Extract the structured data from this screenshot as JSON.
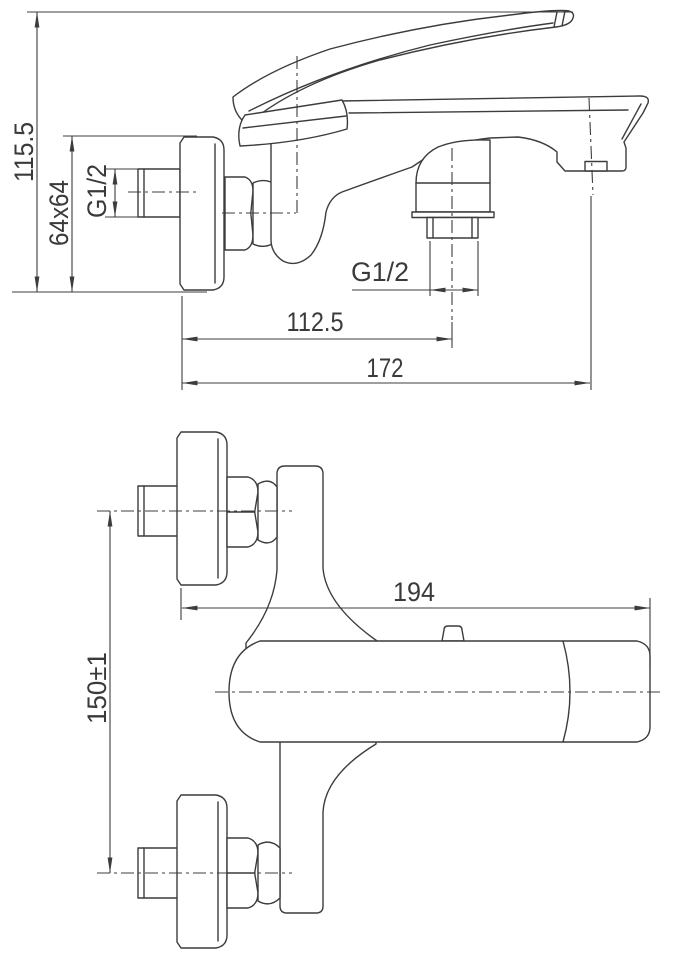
{
  "drawing": {
    "background_color": "#ffffff",
    "line_color": "#3c3c3c",
    "text_color": "#3a3a3a",
    "views": {
      "side_view": {
        "dimensions": [
          {
            "id": "overall-height",
            "label": "115.5",
            "orientation": "vertical"
          },
          {
            "id": "escutcheon-size",
            "label": "64x64",
            "orientation": "vertical"
          },
          {
            "id": "wall-inlet-thread",
            "label": "G1/2",
            "orientation": "vertical"
          },
          {
            "id": "shower-outlet-thread",
            "label": "G1/2",
            "orientation": "horizontal"
          },
          {
            "id": "wall-to-shower-outlet",
            "label": "112.5",
            "orientation": "horizontal"
          },
          {
            "id": "wall-to-spout-tip",
            "label": "172",
            "orientation": "horizontal"
          }
        ]
      },
      "front_view": {
        "dimensions": [
          {
            "id": "spout-reach",
            "label": "194",
            "orientation": "horizontal"
          },
          {
            "id": "inlet-center-spacing",
            "label": "150±1",
            "orientation": "vertical"
          }
        ]
      }
    }
  }
}
